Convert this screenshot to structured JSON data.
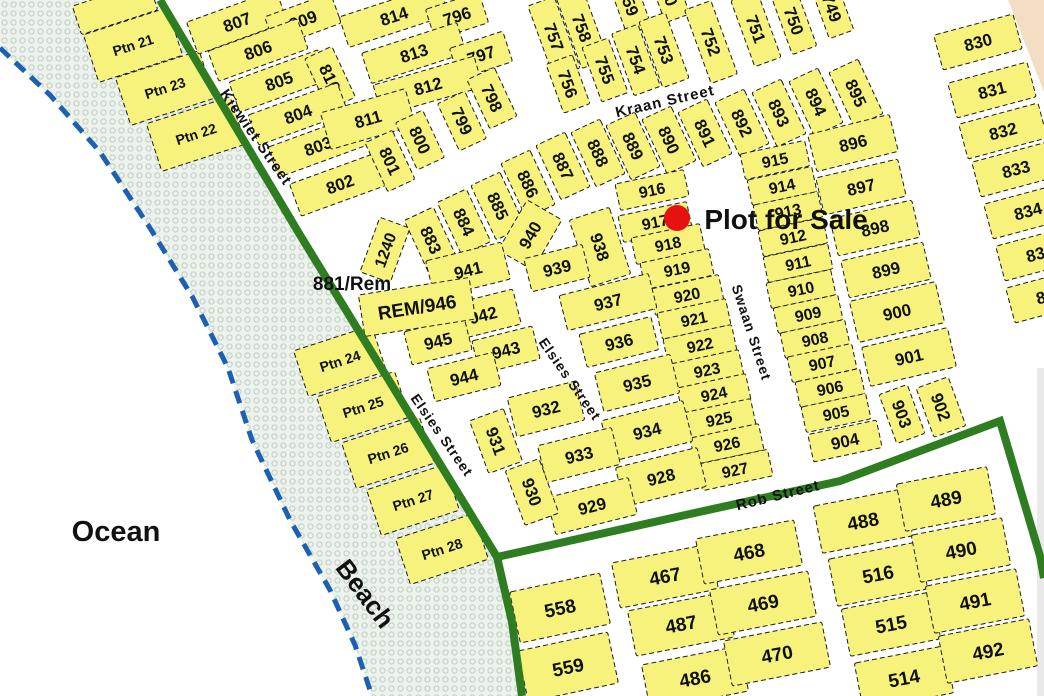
{
  "map": {
    "description_labels": {
      "ocean": "Ocean",
      "beach": "Beach",
      "sale": "Plot for Sale",
      "rem_label": "881/Rem"
    },
    "colors": {
      "plot_fill": "#f7f27b",
      "plot_stroke": "#1c1c1c",
      "road_green": "#2e7d20",
      "coast_blue": "#1b60b2",
      "beach_bg": "#eef2ed",
      "beach_dot": "#bccfc2",
      "peach": "#f3ddc3",
      "sale_red": "#e81111",
      "ocean_text": "#1515dd",
      "beach_text": "#8a6a10",
      "gray_edge": "#e9e9e9"
    },
    "beach_polygon": "160,0 300,235 497,557 512,622 522,696 372,696 355,645 330,590 290,520 252,440 228,368 193,298 150,228 100,152 50,95 0,48 0,0",
    "coastline": "0,48 50,95 100,152 150,228 193,298 228,368 252,440 290,520 330,590 355,645 372,696",
    "peach_polygon": "1008,0 1044,0 1044,92",
    "gray_strip": {
      "x": 1037,
      "y": 368,
      "w": 7,
      "h": 328
    },
    "roads": [
      {
        "name": "kiewiet-elsies-street-line",
        "points": "160,0 300,235 497,557 512,622 522,696"
      },
      {
        "name": "rob-street-line",
        "points": "497,557 690,514 840,481 1000,421 1040,556 1044,578"
      }
    ],
    "plots_format": "[label, cx, cy, w, h, rotation_deg, font_size]",
    "plots": [
      [
        "",
        115,
        8,
        80,
        30,
        -18,
        14
      ],
      [
        "Ptn 21",
        133,
        45,
        88,
        50,
        -18,
        14
      ],
      [
        "Ptn 23",
        165,
        88,
        88,
        50,
        -18,
        14
      ],
      [
        "Ptn 22",
        196,
        134,
        88,
        50,
        -18,
        14
      ],
      [
        "Ptn 24",
        340,
        361,
        82,
        48,
        -18,
        14
      ],
      [
        "Ptn 25",
        363,
        407,
        82,
        48,
        -18,
        14
      ],
      [
        "Ptn 26",
        388,
        453,
        82,
        48,
        -18,
        14
      ],
      [
        "Ptn 27",
        413,
        500,
        82,
        48,
        -18,
        14
      ],
      [
        "Ptn 28",
        442,
        549,
        82,
        48,
        -18,
        14
      ],
      [
        "807",
        237,
        22,
        95,
        34,
        -20,
        17
      ],
      [
        "809",
        303,
        20,
        70,
        32,
        -20,
        17
      ],
      [
        "806",
        258,
        50,
        95,
        32,
        -20,
        17
      ],
      [
        "805",
        279,
        81,
        95,
        32,
        -20,
        17
      ],
      [
        "810",
        330,
        78,
        56,
        30,
        65,
        17
      ],
      [
        "804",
        298,
        114,
        95,
        32,
        -20,
        17
      ],
      [
        "803",
        318,
        146,
        95,
        32,
        -20,
        17
      ],
      [
        "802",
        340,
        184,
        95,
        34,
        -20,
        17
      ],
      [
        "814",
        394,
        16,
        105,
        32,
        -18,
        17
      ],
      [
        "796",
        457,
        16,
        56,
        32,
        -18,
        17
      ],
      [
        "813",
        414,
        53,
        100,
        32,
        -18,
        17
      ],
      [
        "797",
        481,
        55,
        56,
        32,
        -18,
        17
      ],
      [
        "812",
        428,
        86,
        105,
        32,
        -16,
        17
      ],
      [
        "798",
        492,
        98,
        54,
        30,
        65,
        17
      ],
      [
        "811",
        368,
        119,
        88,
        38,
        -16,
        17
      ],
      [
        "800",
        420,
        140,
        52,
        30,
        65,
        17
      ],
      [
        "799",
        462,
        121,
        52,
        30,
        65,
        17
      ],
      [
        "801",
        390,
        161,
        54,
        30,
        65,
        17
      ],
      [
        "757",
        554,
        37,
        76,
        28,
        70,
        17
      ],
      [
        "758",
        582,
        28,
        76,
        28,
        70,
        17
      ],
      [
        "759",
        629,
        2,
        60,
        26,
        70,
        17
      ],
      [
        "760",
        668,
        -8,
        56,
        26,
        70,
        17
      ],
      [
        "756",
        568,
        84,
        52,
        28,
        70,
        17
      ],
      [
        "755",
        605,
        70,
        58,
        28,
        70,
        17
      ],
      [
        "754",
        636,
        60,
        66,
        28,
        70,
        17
      ],
      [
        "753",
        664,
        50,
        70,
        28,
        70,
        17
      ],
      [
        "752",
        711,
        42,
        78,
        28,
        70,
        17
      ],
      [
        "751",
        756,
        29,
        70,
        28,
        70,
        17
      ],
      [
        "750",
        794,
        21,
        62,
        26,
        70,
        17
      ],
      [
        "749",
        832,
        8,
        56,
        26,
        70,
        17
      ],
      [
        "883",
        431,
        240,
        58,
        32,
        65,
        17
      ],
      [
        "884",
        464,
        222,
        58,
        32,
        65,
        17
      ],
      [
        "885",
        498,
        206,
        60,
        32,
        65,
        17
      ],
      [
        "886",
        528,
        184,
        60,
        32,
        65,
        17
      ],
      [
        "887",
        563,
        166,
        60,
        32,
        65,
        17
      ],
      [
        "888",
        598,
        153,
        60,
        32,
        65,
        17
      ],
      [
        "889",
        633,
        146,
        60,
        32,
        65,
        17
      ],
      [
        "890",
        669,
        140,
        60,
        32,
        65,
        17
      ],
      [
        "891",
        705,
        133,
        60,
        32,
        65,
        17
      ],
      [
        "892",
        742,
        123,
        60,
        32,
        65,
        17
      ],
      [
        "893",
        779,
        113,
        60,
        32,
        65,
        17
      ],
      [
        "894",
        816,
        102,
        60,
        32,
        65,
        17
      ],
      [
        "895",
        856,
        93,
        60,
        32,
        65,
        17
      ],
      [
        "896",
        853,
        143,
        84,
        38,
        -14,
        17
      ],
      [
        "897",
        861,
        187,
        84,
        38,
        -13,
        17
      ],
      [
        "898",
        875,
        228,
        84,
        38,
        -13,
        17
      ],
      [
        "899",
        886,
        270,
        84,
        38,
        -13,
        17
      ],
      [
        "900",
        897,
        312,
        88,
        42,
        -13,
        17
      ],
      [
        "901",
        909,
        357,
        88,
        40,
        -13,
        17
      ],
      [
        "903",
        902,
        414,
        52,
        30,
        70,
        17
      ],
      [
        "902",
        941,
        407,
        52,
        34,
        70,
        17
      ],
      [
        "915",
        775,
        160,
        66,
        26,
        -12,
        16
      ],
      [
        "914",
        782,
        186,
        66,
        26,
        -12,
        16
      ],
      [
        "913",
        788,
        211,
        66,
        26,
        -12,
        16
      ],
      [
        "912",
        793,
        237,
        66,
        26,
        -12,
        16
      ],
      [
        "911",
        798,
        263,
        66,
        26,
        -12,
        16
      ],
      [
        "910",
        801,
        289,
        66,
        26,
        -12,
        16
      ],
      [
        "909",
        808,
        314,
        66,
        26,
        -12,
        16
      ],
      [
        "908",
        815,
        339,
        66,
        26,
        -12,
        16
      ],
      [
        "907",
        822,
        363,
        66,
        26,
        -12,
        16
      ],
      [
        "906",
        830,
        388,
        66,
        26,
        -12,
        16
      ],
      [
        "905",
        836,
        413,
        66,
        26,
        -12,
        16
      ],
      [
        "904",
        845,
        441,
        70,
        28,
        -12,
        17
      ],
      [
        "916",
        652,
        190,
        70,
        27,
        -12,
        16
      ],
      [
        "917",
        655,
        222,
        70,
        27,
        -12,
        16
      ],
      [
        "918",
        668,
        244,
        70,
        27,
        -12,
        16
      ],
      [
        "919",
        677,
        269,
        70,
        27,
        -12,
        16
      ],
      [
        "920",
        687,
        295,
        70,
        27,
        -12,
        16
      ],
      [
        "921",
        694,
        319,
        70,
        27,
        -12,
        16
      ],
      [
        "922",
        700,
        345,
        70,
        27,
        -12,
        16
      ],
      [
        "923",
        707,
        370,
        70,
        27,
        -12,
        16
      ],
      [
        "924",
        714,
        394,
        70,
        27,
        -12,
        16
      ],
      [
        "925",
        719,
        419,
        70,
        27,
        -12,
        16
      ],
      [
        "926",
        727,
        444,
        70,
        27,
        -12,
        16
      ],
      [
        "927",
        735,
        470,
        72,
        27,
        -12,
        16
      ],
      [
        "938",
        600,
        247,
        70,
        42,
        72,
        17
      ],
      [
        "940",
        530,
        235,
        58,
        40,
        -60,
        17
      ],
      [
        "939",
        557,
        268,
        60,
        34,
        -14,
        17
      ],
      [
        "937",
        608,
        302,
        92,
        36,
        -14,
        17
      ],
      [
        "936",
        619,
        342,
        74,
        34,
        -14,
        17
      ],
      [
        "935",
        637,
        383,
        78,
        40,
        -14,
        17
      ],
      [
        "934",
        647,
        431,
        84,
        42,
        -14,
        17
      ],
      [
        "928",
        661,
        477,
        84,
        40,
        -14,
        17
      ],
      [
        "929",
        592,
        506,
        84,
        38,
        -14,
        17
      ],
      [
        "933",
        579,
        455,
        76,
        38,
        -14,
        17
      ],
      [
        "932",
        546,
        409,
        70,
        40,
        -14,
        17
      ],
      [
        "931",
        496,
        441,
        56,
        36,
        70,
        17
      ],
      [
        "930",
        532,
        492,
        58,
        36,
        70,
        17
      ],
      [
        "1240",
        385,
        250,
        58,
        32,
        -70,
        16
      ],
      [
        "941",
        468,
        270,
        78,
        38,
        -14,
        17
      ],
      [
        "942",
        483,
        315,
        70,
        36,
        -14,
        17
      ],
      [
        "945",
        438,
        341,
        62,
        34,
        -14,
        17
      ],
      [
        "943",
        506,
        350,
        62,
        34,
        -14,
        17
      ],
      [
        "944",
        464,
        377,
        68,
        34,
        -14,
        17
      ],
      [
        "REM/946",
        417,
        307,
        112,
        42,
        -9,
        19
      ],
      [
        "830",
        978,
        42,
        82,
        36,
        -15,
        17
      ],
      [
        "831",
        992,
        90,
        82,
        36,
        -15,
        17
      ],
      [
        "832",
        1003,
        131,
        82,
        36,
        -15,
        17
      ],
      [
        "833",
        1016,
        169,
        82,
        36,
        -15,
        17
      ],
      [
        "834",
        1028,
        211,
        82,
        36,
        -15,
        17
      ],
      [
        "835",
        1040,
        253,
        82,
        36,
        -15,
        17
      ],
      [
        "836",
        1050,
        295,
        82,
        36,
        -15,
        17
      ],
      [
        "558",
        560,
        608,
        92,
        52,
        -12,
        19
      ],
      [
        "559",
        568,
        667,
        92,
        52,
        -12,
        19
      ],
      [
        "467",
        665,
        576,
        100,
        46,
        -11,
        19
      ],
      [
        "468",
        749,
        552,
        100,
        46,
        -11,
        19
      ],
      [
        "487",
        681,
        624,
        100,
        46,
        -11,
        19
      ],
      [
        "469",
        763,
        603,
        100,
        46,
        -11,
        19
      ],
      [
        "486",
        695,
        678,
        100,
        46,
        -11,
        19
      ],
      [
        "470",
        777,
        654,
        100,
        46,
        -11,
        19
      ],
      [
        "488",
        863,
        521,
        92,
        48,
        -11,
        19
      ],
      [
        "489",
        946,
        499,
        92,
        48,
        -11,
        19
      ],
      [
        "516",
        878,
        574,
        92,
        48,
        -11,
        19
      ],
      [
        "490",
        961,
        550,
        92,
        48,
        -11,
        19
      ],
      [
        "515",
        891,
        624,
        92,
        48,
        -11,
        19
      ],
      [
        "491",
        975,
        601,
        92,
        48,
        -11,
        19
      ],
      [
        "514",
        904,
        678,
        92,
        48,
        -11,
        19
      ],
      [
        "492",
        988,
        651,
        92,
        48,
        -11,
        19
      ]
    ],
    "street_labels": [
      {
        "text": "Kiewiet Street",
        "x": 252,
        "y": 140,
        "rot": 55,
        "fs": 15
      },
      {
        "text": "Kraan Street",
        "x": 666,
        "y": 106,
        "rot": -13,
        "fs": 15
      },
      {
        "text": "Elsies Street",
        "x": 566,
        "y": 382,
        "rot": 55,
        "fs": 14
      },
      {
        "text": "Elsies Street",
        "x": 438,
        "y": 438,
        "rot": 55,
        "fs": 14
      },
      {
        "text": "Swaan Street",
        "x": 747,
        "y": 334,
        "rot": 72,
        "fs": 14
      },
      {
        "text": "Rob Street",
        "x": 779,
        "y": 500,
        "rot": -14,
        "fs": 15
      }
    ],
    "text_labels": [
      {
        "name": "ocean-label",
        "text": "Ocean",
        "x": 116,
        "y": 541,
        "rot": 0,
        "fs": 29,
        "color": "#1515dd"
      },
      {
        "name": "beach-label",
        "text": "Beach",
        "x": 358,
        "y": 599,
        "rot": 53,
        "fs": 26,
        "color": "#8a6a10"
      },
      {
        "name": "plot-881-rem-label",
        "text": "881/Rem",
        "x": 352,
        "y": 290,
        "rot": 0,
        "fs": 19,
        "color": "#111111"
      }
    ],
    "marker": {
      "label": "Plot for Sale",
      "dot_x": 677,
      "dot_y": 218,
      "dot_r": 13,
      "text_x": 786,
      "text_y": 229,
      "fs": 28
    }
  }
}
